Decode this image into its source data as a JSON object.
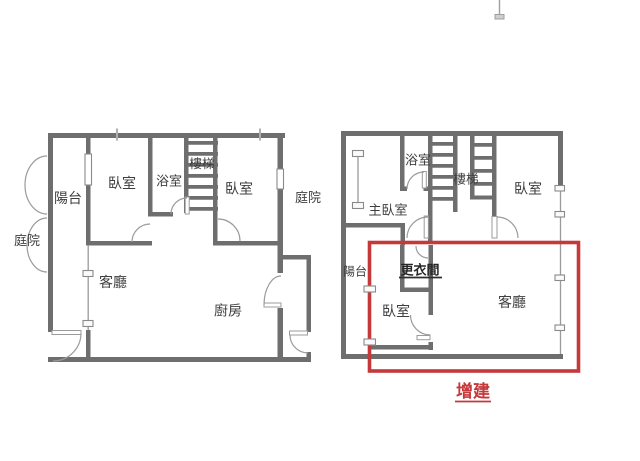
{
  "image": {
    "width": 640,
    "height": 461,
    "background": "#ffffff",
    "description": "Two floor plans side by side; the right plan has a red rectangle marking an addition"
  },
  "colors": {
    "wall": "#6e6e6e",
    "line": "#9b9b9b",
    "text": "#3e3e3e",
    "closet_text": "#262626",
    "highlight": "#c5393b"
  },
  "left_plan": {
    "labels": {
      "courtyard_left": "庭院",
      "balcony": "陽台",
      "bedroom_left": "臥室",
      "bathroom": "浴室",
      "stairs": "樓梯",
      "bedroom_right": "臥室",
      "courtyard_right": "庭院",
      "living_room": "客廳",
      "kitchen": "廚房"
    }
  },
  "right_plan": {
    "labels": {
      "bathroom": "浴室",
      "stairs": "樓梯",
      "bedroom_top": "臥室",
      "master_bedroom": "主臥室",
      "balcony": "陽台",
      "closet": "更衣間",
      "bedroom_bottom": "臥室",
      "living_room": "客廳"
    },
    "annotation": "增建"
  }
}
